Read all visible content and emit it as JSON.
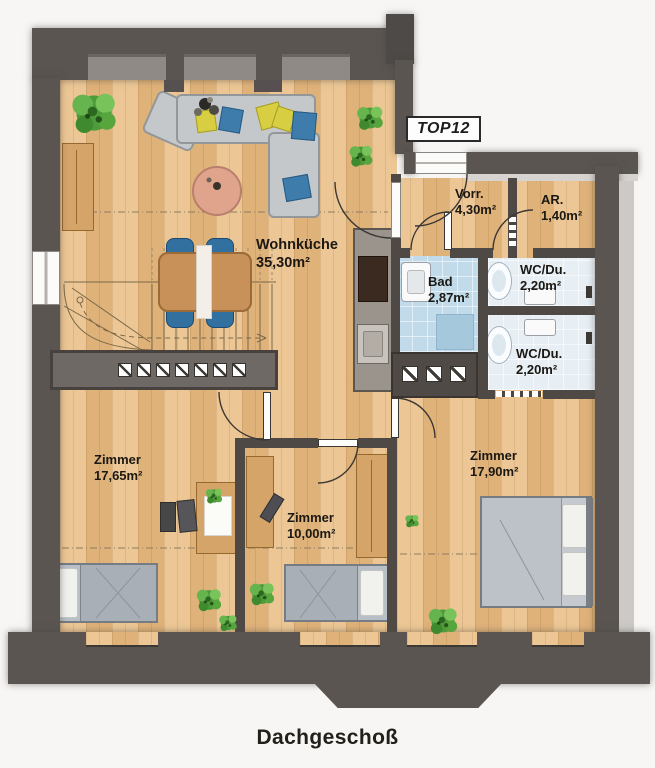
{
  "plan": {
    "unit_label": "TOP12",
    "floor_title": "Dachgeschoß",
    "rooms": [
      {
        "id": "wohnkueche",
        "name": "Wohnküche",
        "area": "35,30m²"
      },
      {
        "id": "vorraum",
        "name": "Vorr.",
        "area": "4,30m²"
      },
      {
        "id": "abstellraum",
        "name": "AR.",
        "area": "1,40m²"
      },
      {
        "id": "bad",
        "name": "Bad",
        "area": "2,87m²"
      },
      {
        "id": "wc-du-1",
        "name": "WC/Du.",
        "area": "2,20m²"
      },
      {
        "id": "wc-du-2",
        "name": "WC/Du.",
        "area": "2,20m²"
      },
      {
        "id": "zimmer-1",
        "name": "Zimmer",
        "area": "17,65m²"
      },
      {
        "id": "zimmer-2",
        "name": "Zimmer",
        "area": "10,00m²"
      },
      {
        "id": "zimmer-3",
        "name": "Zimmer",
        "area": "17,90m²"
      }
    ],
    "colors": {
      "wall": "#5a5551",
      "wood_floor": "#e6bd86",
      "bath_floor": "#c2dbea",
      "accent_blue": "#3e7cab",
      "accent_yellow": "#d8ce41",
      "plant_green": "#4e9b3c",
      "furniture_gray": "#c5c8ca"
    }
  }
}
